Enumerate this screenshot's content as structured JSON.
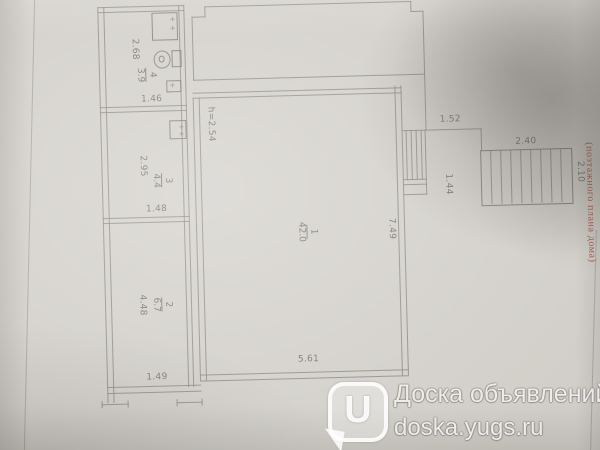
{
  "plan": {
    "fixture_mark": "+",
    "rooms": [
      {
        "number": "1",
        "area": "42.0",
        "ceiling": "h=2.54",
        "width_label": "5.61",
        "depth_label": "7.49"
      },
      {
        "number": "2",
        "area": "6.7",
        "width_label": "1.49",
        "depth_label": "4.48"
      },
      {
        "number": "3",
        "area": "4.4",
        "width_label": "1.48",
        "depth_label": "2.95"
      },
      {
        "number": "4",
        "area": "3.9",
        "width_label": "1.46",
        "depth_label": "2.68"
      }
    ],
    "annex": {
      "width_label": "1.52",
      "depth_label": "1.44"
    },
    "stairs": {
      "width_label": "2.40",
      "depth_label": "2.10"
    }
  },
  "stamp": {
    "text": "(поэтажного плана дома)"
  },
  "watermark": {
    "title": "Доска объявлений",
    "url": "doska.yugs.ru",
    "logo_letter": "U"
  }
}
